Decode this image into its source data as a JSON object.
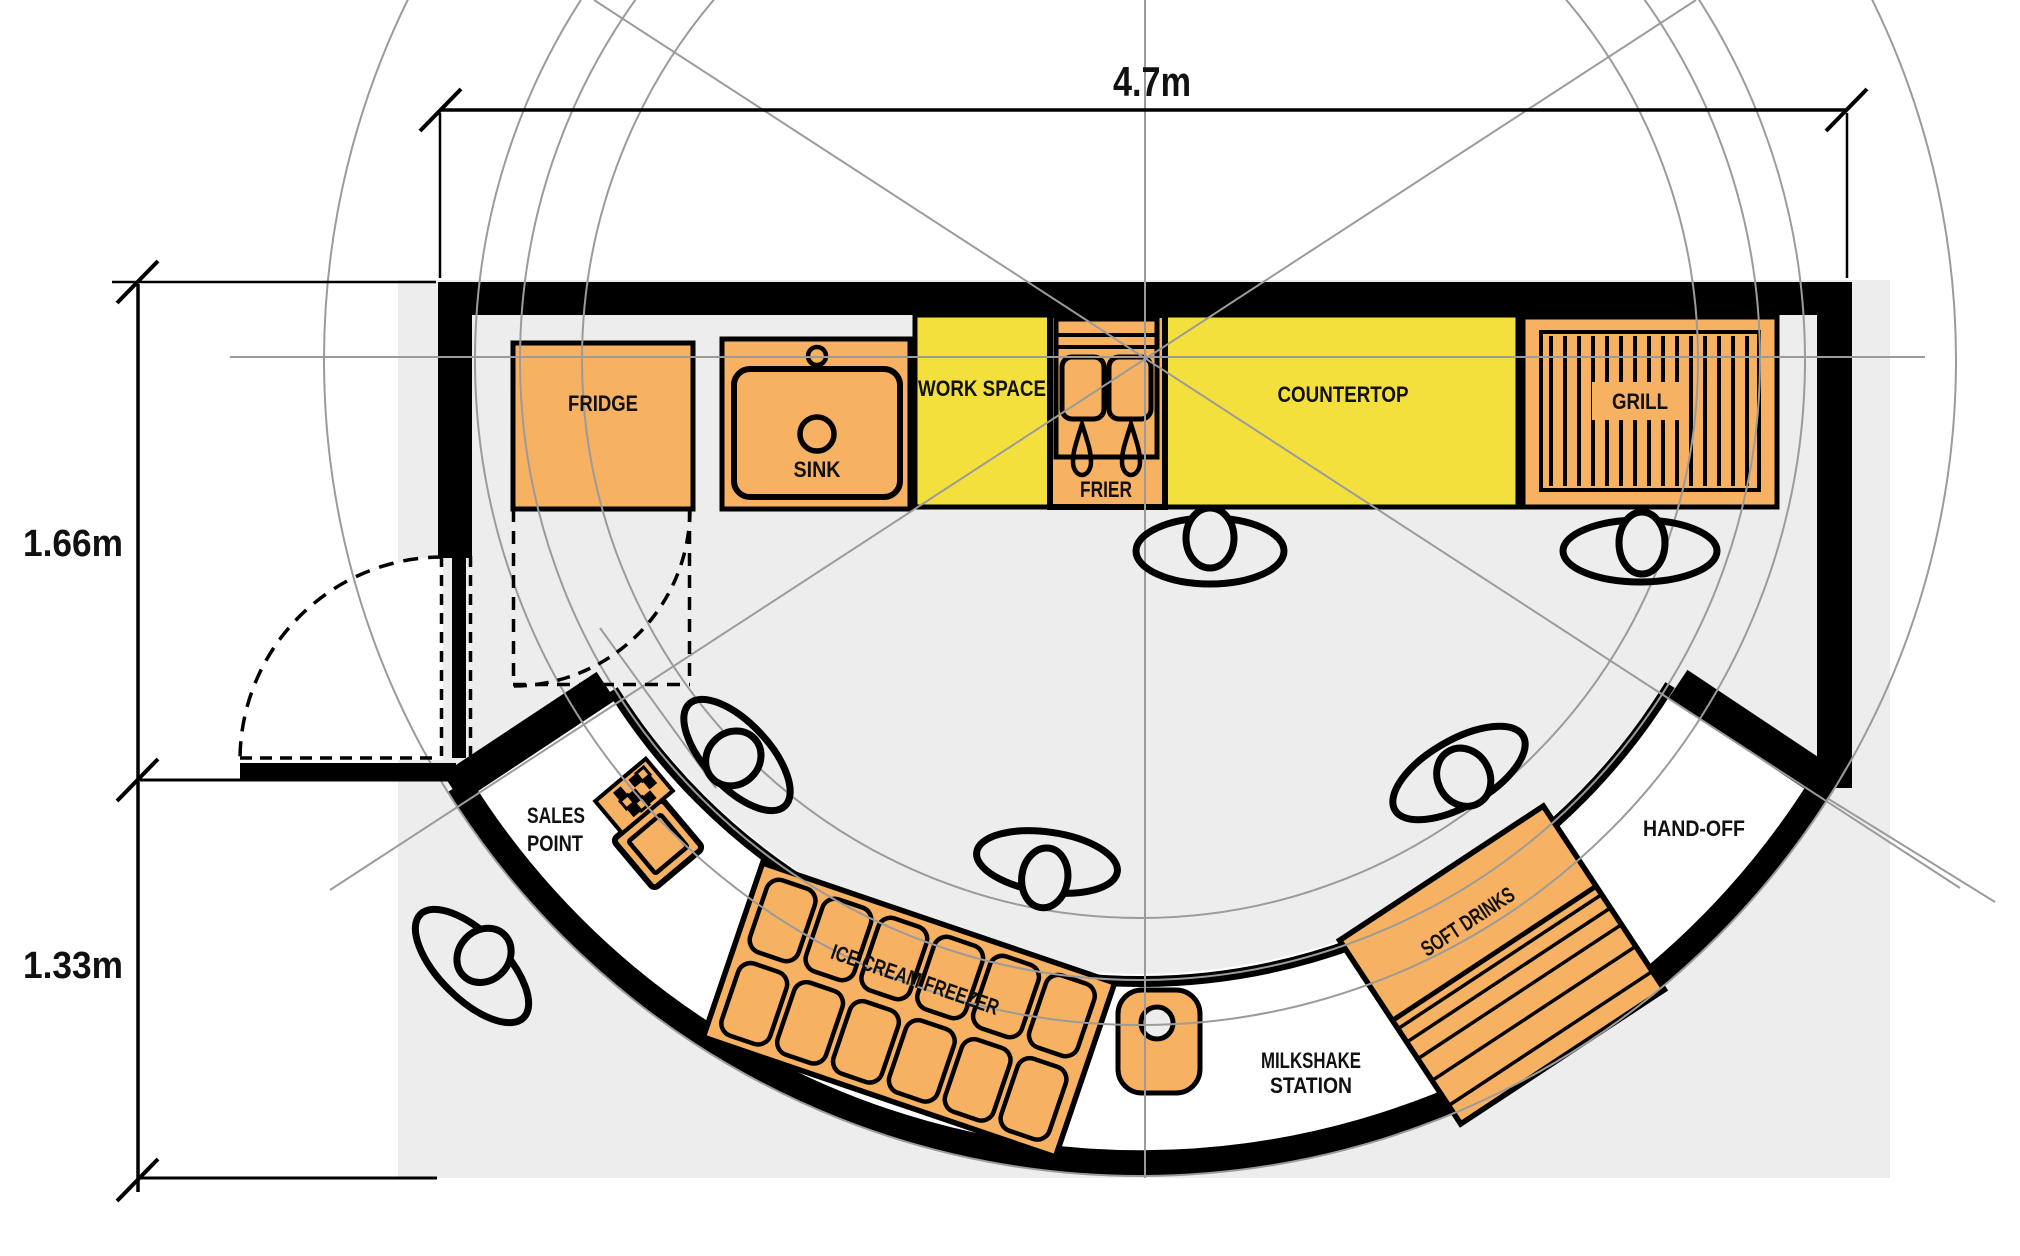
{
  "page": {
    "title": "Snack kiosk floor plan",
    "background": "#ffffff"
  },
  "dimensions": {
    "top_width": "4.7m",
    "left_upper": "1.66m",
    "left_lower": "1.33m"
  },
  "areas": {
    "fridge": "FRIDGE",
    "sink": "SINK",
    "work_space": "WORK SPACE",
    "frier": "FRIER",
    "countertop": "COUNTERTOP",
    "grill": "GRILL",
    "sales_point_line1": "SALES",
    "sales_point_line2": "POINT",
    "ice_cream_freezer": "ICE CREAM FREEZER",
    "milkshake_line1": "MILKSHAKE",
    "milkshake_line2": "STATION",
    "soft_drinks": "SOFT DRINKS",
    "hand_off": "HAND-OFF"
  },
  "colors": {
    "appliance_orange": "#f7b163",
    "counter_yellow": "#f3e03c",
    "floor_gray": "#ededed",
    "wall_black": "#000000",
    "construction_gray": "#9b9b9b"
  }
}
